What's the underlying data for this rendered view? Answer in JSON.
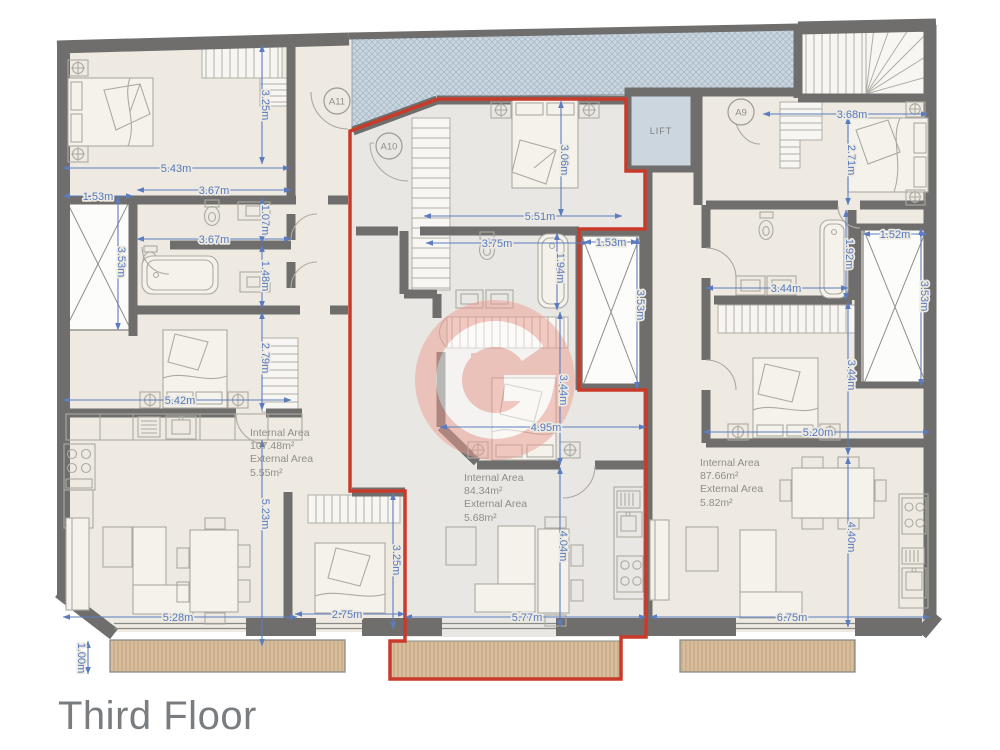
{
  "title": "Third Floor",
  "lift_label": "LIFT",
  "markers": [
    "A11",
    "A10",
    "A9"
  ],
  "watermark_letter": "G",
  "areas": {
    "left": {
      "internal_label": "Internal Area",
      "internal_value": "107.48m²",
      "external_label": "External Area",
      "external_value": "5.55m²"
    },
    "center": {
      "internal_label": "Internal Area",
      "internal_value": "84.34m²",
      "external_label": "External Area",
      "external_value": "5.68m²"
    },
    "right": {
      "internal_label": "Internal Area",
      "internal_value": "87.66m²",
      "external_label": "External Area",
      "external_value": "5.82m²"
    }
  },
  "dims": [
    "5.43m",
    "3.25m",
    "1.53m",
    "3.67m",
    "1.07m",
    "3.67m",
    "1.48m",
    "3.53m",
    "5.42m",
    "2.79m",
    "5.23m",
    "5.28m",
    "1.00m",
    "3.06m",
    "5.51m",
    "3.75m",
    "1.94m",
    "1.53m",
    "3.53m",
    "3.44m",
    "4.95m",
    "4.04m",
    "5.77m",
    "3.25m",
    "2.75m",
    "3.68m",
    "2.71m",
    "1.52m",
    "3.53m",
    "1.92m",
    "3.44m",
    "3.44m",
    "5.20m",
    "4.40m",
    "6.75m"
  ],
  "colors": {
    "red_outline": "#C93A2B",
    "dimension_blue": "#5B7CBE",
    "wall_gray": "#6F6E6C",
    "terrace_blue": "#CBD6DF",
    "balcony_tan": "#D8BE9F",
    "watermark_salmon": "#EC9E92"
  }
}
